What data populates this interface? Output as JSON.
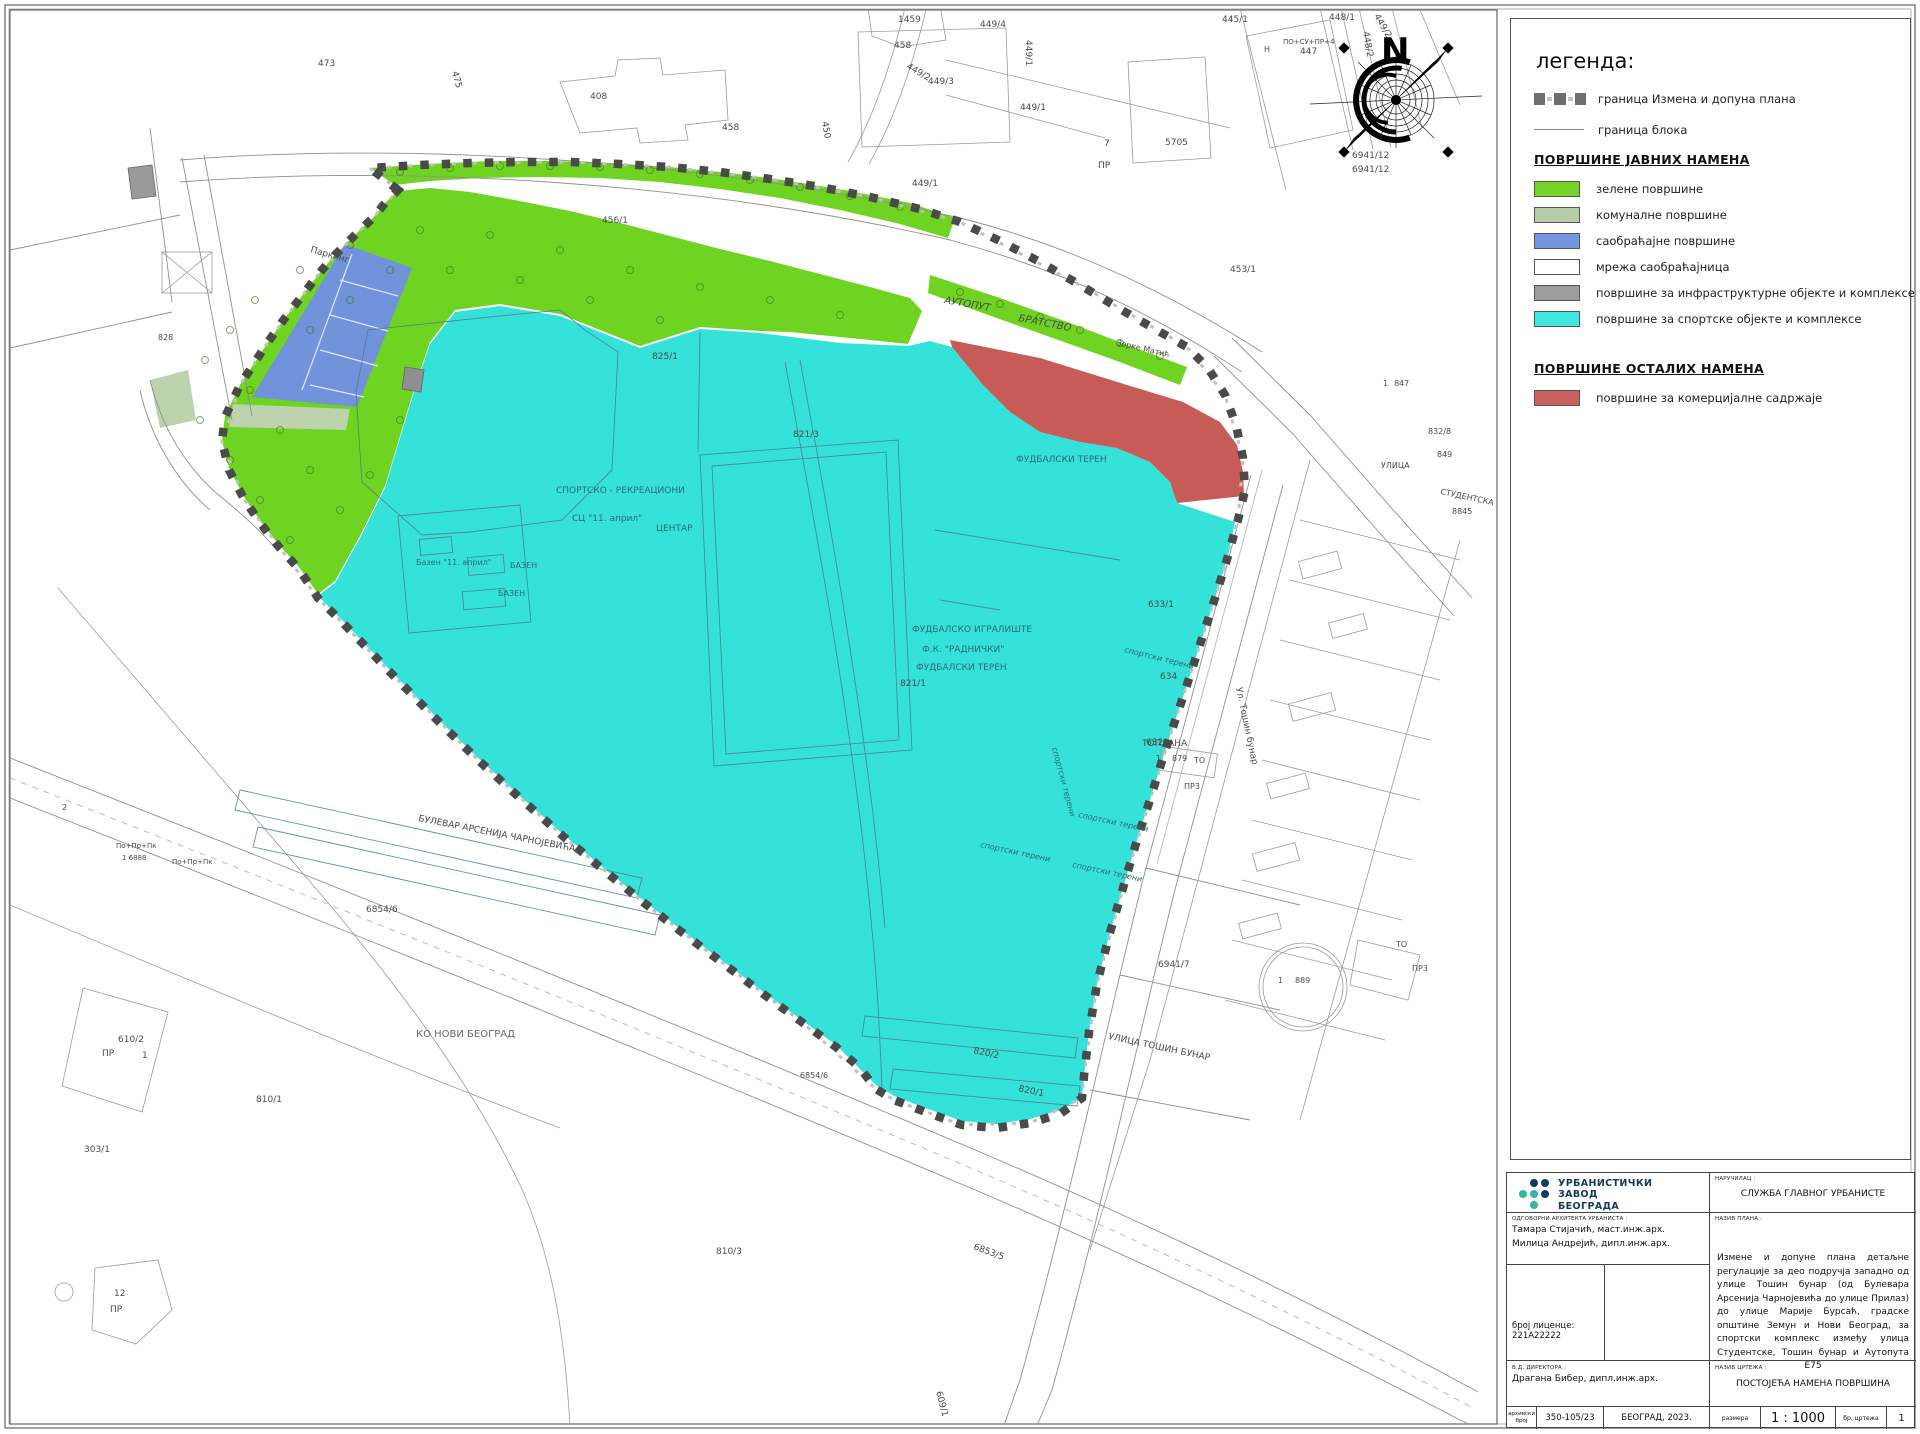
{
  "colors": {
    "green": "#6FD321",
    "green_legend": "#74D428",
    "komunalne": "#BCD3AE",
    "blue": "#7193DB",
    "white": "#FFFFFF",
    "gray_infra": "#9A9A9A",
    "cyan": "#35E2D9",
    "cyan_legend": "#3FE8DF",
    "red": "#C65B58",
    "boundary": "#4A4A4A",
    "logo_navy": "#14395E",
    "logo_teal": "#35B5A8"
  },
  "compass": {
    "north_label": "N"
  },
  "legend": {
    "title": "легенда:",
    "boundary_items": [
      {
        "type": "dashed-squares",
        "label": "граница Измена и допуна плана"
      },
      {
        "type": "line",
        "label": "граница блока"
      }
    ],
    "sections": [
      {
        "heading": "ПОВРШИНЕ ЈАВНИХ НАМЕНА",
        "items": [
          {
            "label": "зелене површине",
            "color": "#74D428"
          },
          {
            "label": "комуналне површине",
            "color": "#B5CEA8"
          },
          {
            "label": "саобраћајне површине",
            "color": "#7396DF"
          },
          {
            "label": "мрежа саобраћајница",
            "color": "#FFFFFF"
          },
          {
            "label": "површине за инфраструктурне објекте и комплексе",
            "color": "#9C9C9C"
          },
          {
            "label": "површине за спортске објекте и комплексе",
            "color": "#3FE8DF"
          }
        ]
      },
      {
        "heading": "ПОВРШИНЕ ОСТАЛИХ НАМЕНА",
        "items": [
          {
            "label": "површине за комерцијалне садржаје",
            "color": "#C8605E"
          }
        ]
      }
    ]
  },
  "title_block": {
    "company_lines": [
      "УРБАНИСТИЧКИ",
      "ЗАВОД",
      "БЕОГРАДА"
    ],
    "client_label": "НАРУЧИЛАЦ :",
    "client": "СЛУЖБА ГЛАВНОГ УРБАНИСТЕ",
    "architects_label": "ОДГОВОРНИ АРХИТЕКТА УРБАНИСТА :",
    "architects": [
      "Тамара Стијачић, маст.инж.арх.",
      "Милица Андрејић, дипл.инж.арх."
    ],
    "license": "број лиценце: 221А22222",
    "plan_label": "НАЗИВ ПЛАНА :",
    "plan_title": "Измене и допуне плана детаљне регулације за део подручја западно од улице Тошин бунар (од Булевара Арсенија Чарнојевића до улице Прилаз) до улице Марије Бурсаћ, градске општине Земун и Нови Београд, за спортски комплекс између улица Студентске, Тошин бунар и Аутопута Е75",
    "director_label": "В.Д. ДИРЕКТОРА :",
    "director": "Драгана Бибер, дипл.инж.арх.",
    "drawing_label": "НАЗИВ ЦРТЕЖА :",
    "drawing_title": "ПОСТОЈЕЋА НАМЕНА ПОВРШИНА",
    "archive_label": "архивски број",
    "archive_no": "350-105/23",
    "place": "БЕОГРАД, 2023.",
    "scale_label": "размера",
    "scale": "1 : 1000",
    "sheet_label": "бр. цртежа",
    "sheet_no": "1",
    "logo_dots": [
      [
        0,
        1,
        1
      ],
      [
        2,
        2,
        1
      ],
      [
        0,
        2,
        0
      ]
    ]
  },
  "map_labels": [
    {
      "t": "473",
      "x": 318,
      "y": 66,
      "r": 0,
      "s": 9
    },
    {
      "t": "475",
      "x": 452,
      "y": 72,
      "r": 75,
      "s": 9
    },
    {
      "t": "408",
      "x": 590,
      "y": 99,
      "r": 0,
      "s": 9
    },
    {
      "t": "458",
      "x": 722,
      "y": 130,
      "r": 0,
      "s": 9
    },
    {
      "t": "1459",
      "x": 898,
      "y": 22,
      "r": 0,
      "s": 9
    },
    {
      "t": "458",
      "x": 894,
      "y": 48,
      "r": 0,
      "s": 9
    },
    {
      "t": "449/4",
      "x": 980,
      "y": 27,
      "r": 0,
      "s": 9
    },
    {
      "t": "449/1",
      "x": 1026,
      "y": 40,
      "r": 90,
      "s": 9
    },
    {
      "t": "449/2",
      "x": 906,
      "y": 68,
      "r": 30,
      "s": 9
    },
    {
      "t": "449/3",
      "x": 928,
      "y": 84,
      "r": 0,
      "s": 9
    },
    {
      "t": "450",
      "x": 822,
      "y": 122,
      "r": 80,
      "s": 9
    },
    {
      "t": "449/1",
      "x": 912,
      "y": 186,
      "r": 0,
      "s": 9
    },
    {
      "t": "456/1",
      "x": 602,
      "y": 223,
      "r": 0,
      "s": 9
    },
    {
      "t": "445/1",
      "x": 1222,
      "y": 22,
      "r": 0,
      "s": 9
    },
    {
      "t": "ПО+СУ+ПР+4",
      "x": 1283,
      "y": 44,
      "r": 0,
      "s": 7
    },
    {
      "t": "447",
      "x": 1300,
      "y": 54,
      "r": 0,
      "s": 9
    },
    {
      "t": "Н",
      "x": 1264,
      "y": 52,
      "r": 0,
      "s": 8
    },
    {
      "t": "448/1",
      "x": 1329,
      "y": 20,
      "r": 0,
      "s": 9
    },
    {
      "t": "448/2",
      "x": 1363,
      "y": 32,
      "r": 80,
      "s": 9
    },
    {
      "t": "449/2",
      "x": 1374,
      "y": 16,
      "r": 60,
      "s": 9
    },
    {
      "t": "5705",
      "x": 1165,
      "y": 145,
      "r": 0,
      "s": 9
    },
    {
      "t": "6941/12",
      "x": 1352,
      "y": 158,
      "r": 0,
      "s": 9
    },
    {
      "t": "6941/12",
      "x": 1352,
      "y": 172,
      "r": 0,
      "s": 9
    },
    {
      "t": "453/1",
      "x": 1230,
      "y": 272,
      "r": 0,
      "s": 9
    },
    {
      "t": "7",
      "x": 1104,
      "y": 146,
      "r": 0,
      "s": 9
    },
    {
      "t": "ПР",
      "x": 1098,
      "y": 168,
      "r": 0,
      "s": 9
    },
    {
      "t": "828",
      "x": 158,
      "y": 340,
      "r": 0,
      "s": 8
    },
    {
      "t": "АУТОПУТ",
      "x": 944,
      "y": 303,
      "r": 10,
      "s": 10,
      "i": 1
    },
    {
      "t": "БРАТСТВО",
      "x": 1018,
      "y": 321,
      "r": 11,
      "s": 10,
      "i": 1
    },
    {
      "t": "Зорке Матић",
      "x": 1116,
      "y": 345,
      "r": 13,
      "s": 8
    },
    {
      "t": "Паркинг",
      "x": 310,
      "y": 252,
      "r": 16,
      "s": 9
    },
    {
      "t": "СПОРТСКО - РЕКРЕАЦИОНИ",
      "x": 556,
      "y": 493,
      "r": 0,
      "s": 9,
      "c": "#2a6b74"
    },
    {
      "t": "СЦ \"11. април\"",
      "x": 572,
      "y": 521,
      "r": 0,
      "s": 9,
      "c": "#2a6b74"
    },
    {
      "t": "ЦЕНТАР",
      "x": 656,
      "y": 531,
      "r": 0,
      "s": 9,
      "c": "#2a6b74"
    },
    {
      "t": "Базен \"11. април\"",
      "x": 416,
      "y": 565,
      "r": 0,
      "s": 8,
      "c": "#2a6b74"
    },
    {
      "t": "БАЗЕН",
      "x": 510,
      "y": 568,
      "r": 0,
      "s": 8,
      "c": "#2a6b74"
    },
    {
      "t": "БАЗЕН",
      "x": 498,
      "y": 596,
      "r": 0,
      "s": 8,
      "c": "#2a6b74"
    },
    {
      "t": "ФУДБАЛСКО  ИГРАЛИШТЕ",
      "x": 912,
      "y": 632,
      "r": 0,
      "s": 9,
      "c": "#2a6b74"
    },
    {
      "t": "Ф.К. \"РАДНИЧКИ\"",
      "x": 922,
      "y": 652,
      "r": 0,
      "s": 9,
      "c": "#2a6b74"
    },
    {
      "t": "ФУДБАЛСКИ ТЕРЕН",
      "x": 916,
      "y": 670,
      "r": 0,
      "s": 9,
      "c": "#2a6b74"
    },
    {
      "t": "ФУДБАЛСКИ ТЕРЕН",
      "x": 1016,
      "y": 462,
      "r": 0,
      "s": 9,
      "c": "#2a6b74"
    },
    {
      "t": "825/1",
      "x": 652,
      "y": 359,
      "r": 0,
      "s": 9
    },
    {
      "t": "821/3",
      "x": 793,
      "y": 437,
      "r": 0,
      "s": 9
    },
    {
      "t": "821/1",
      "x": 900,
      "y": 686,
      "r": 0,
      "s": 9
    },
    {
      "t": "633/1",
      "x": 1148,
      "y": 607,
      "r": 0,
      "s": 9
    },
    {
      "t": "634",
      "x": 1160,
      "y": 679,
      "r": 0,
      "s": 9
    },
    {
      "t": "632",
      "x": 1146,
      "y": 745,
      "r": 0,
      "s": 9
    },
    {
      "t": "спортски терени",
      "x": 1124,
      "y": 652,
      "r": 14,
      "s": 8,
      "i": 1,
      "c": "#2a6b74"
    },
    {
      "t": "спортски терени",
      "x": 1052,
      "y": 748,
      "r": 75,
      "s": 8,
      "i": 1,
      "c": "#2a6b74"
    },
    {
      "t": "спортски терени",
      "x": 1078,
      "y": 817,
      "r": 12,
      "s": 8,
      "i": 1,
      "c": "#2a6b74"
    },
    {
      "t": "спортски терени",
      "x": 980,
      "y": 847,
      "r": 12,
      "s": 8,
      "i": 1,
      "c": "#2a6b74"
    },
    {
      "t": "спортски терени",
      "x": 1072,
      "y": 867,
      "r": 12,
      "s": 8,
      "i": 1,
      "c": "#2a6b74"
    },
    {
      "t": "820/2",
      "x": 973,
      "y": 1053,
      "r": 12,
      "s": 9
    },
    {
      "t": "820/1",
      "x": 1018,
      "y": 1091,
      "r": 12,
      "s": 9
    },
    {
      "t": "Ул. Тошин бунар",
      "x": 1236,
      "y": 688,
      "r": 78,
      "s": 9
    },
    {
      "t": "УЛИЦА ТОШИН БУНАР",
      "x": 1108,
      "y": 1039,
      "r": 12,
      "s": 9
    },
    {
      "t": "6941/7",
      "x": 1158,
      "y": 967,
      "r": 0,
      "s": 9
    },
    {
      "t": "КО НОВИ БЕОГРАД",
      "x": 416,
      "y": 1037,
      "r": 0,
      "s": 10,
      "c": "#666"
    },
    {
      "t": "БУЛЕВАР АРСЕНИЈА ЧАРНОЈЕВИЋА",
      "x": 418,
      "y": 821,
      "r": 11,
      "s": 9
    },
    {
      "t": "6854/6",
      "x": 366,
      "y": 912,
      "r": 0,
      "s": 9
    },
    {
      "t": "610/2",
      "x": 118,
      "y": 1042,
      "r": 0,
      "s": 9
    },
    {
      "t": "ПР",
      "x": 102,
      "y": 1056,
      "r": 0,
      "s": 9
    },
    {
      "t": "1",
      "x": 142,
      "y": 1058,
      "r": 0,
      "s": 9
    },
    {
      "t": "По+Пр+Пк",
      "x": 116,
      "y": 848,
      "r": 0,
      "s": 7
    },
    {
      "t": "1  6888",
      "x": 122,
      "y": 860,
      "r": 0,
      "s": 7
    },
    {
      "t": "По+Пр+Пк",
      "x": 172,
      "y": 864,
      "r": 0,
      "s": 7
    },
    {
      "t": "2",
      "x": 62,
      "y": 810,
      "r": 0,
      "s": 8
    },
    {
      "t": "12",
      "x": 114,
      "y": 1296,
      "r": 0,
      "s": 9
    },
    {
      "t": "ПР",
      "x": 110,
      "y": 1312,
      "r": 0,
      "s": 9
    },
    {
      "t": "303/1",
      "x": 84,
      "y": 1152,
      "r": 0,
      "s": 9
    },
    {
      "t": "810/1",
      "x": 256,
      "y": 1102,
      "r": 0,
      "s": 9
    },
    {
      "t": "810/3",
      "x": 716,
      "y": 1254,
      "r": 0,
      "s": 9
    },
    {
      "t": "6853/5",
      "x": 973,
      "y": 1249,
      "r": 20,
      "s": 9
    },
    {
      "t": "609/1",
      "x": 936,
      "y": 1392,
      "r": 75,
      "s": 9
    },
    {
      "t": "ТОПЛАНА",
      "x": 1142,
      "y": 746,
      "r": 0,
      "s": 9
    },
    {
      "t": "1",
      "x": 1156,
      "y": 761,
      "r": 0,
      "s": 8
    },
    {
      "t": "879",
      "x": 1172,
      "y": 761,
      "r": 0,
      "s": 8
    },
    {
      "t": "ТО",
      "x": 1194,
      "y": 763,
      "r": 0,
      "s": 8
    },
    {
      "t": "ПР3",
      "x": 1184,
      "y": 789,
      "r": 0,
      "s": 8
    },
    {
      "t": "1",
      "x": 1278,
      "y": 983,
      "r": 0,
      "s": 8
    },
    {
      "t": "889",
      "x": 1295,
      "y": 983,
      "r": 0,
      "s": 8
    },
    {
      "t": "ТО",
      "x": 1396,
      "y": 947,
      "r": 0,
      "s": 8
    },
    {
      "t": "ПР3",
      "x": 1412,
      "y": 971,
      "r": 0,
      "s": 8
    },
    {
      "t": "1",
      "x": 1383,
      "y": 386,
      "r": 0,
      "s": 8
    },
    {
      "t": "847",
      "x": 1394,
      "y": 386,
      "r": 0,
      "s": 8
    },
    {
      "t": "832/8",
      "x": 1428,
      "y": 434,
      "r": 0,
      "s": 8
    },
    {
      "t": "849",
      "x": 1437,
      "y": 457,
      "r": 0,
      "s": 8
    },
    {
      "t": "УЛИЦА",
      "x": 1381,
      "y": 468,
      "r": 0,
      "s": 8
    },
    {
      "t": "СТУДЕНТСКА",
      "x": 1440,
      "y": 494,
      "r": 12,
      "s": 8
    },
    {
      "t": "8845",
      "x": 1452,
      "y": 514,
      "r": 0,
      "s": 8
    },
    {
      "t": "6854/6",
      "x": 800,
      "y": 1078,
      "r": 0,
      "s": 8
    },
    {
      "t": "449/1",
      "x": 1020,
      "y": 110,
      "r": 0,
      "s": 9
    }
  ]
}
